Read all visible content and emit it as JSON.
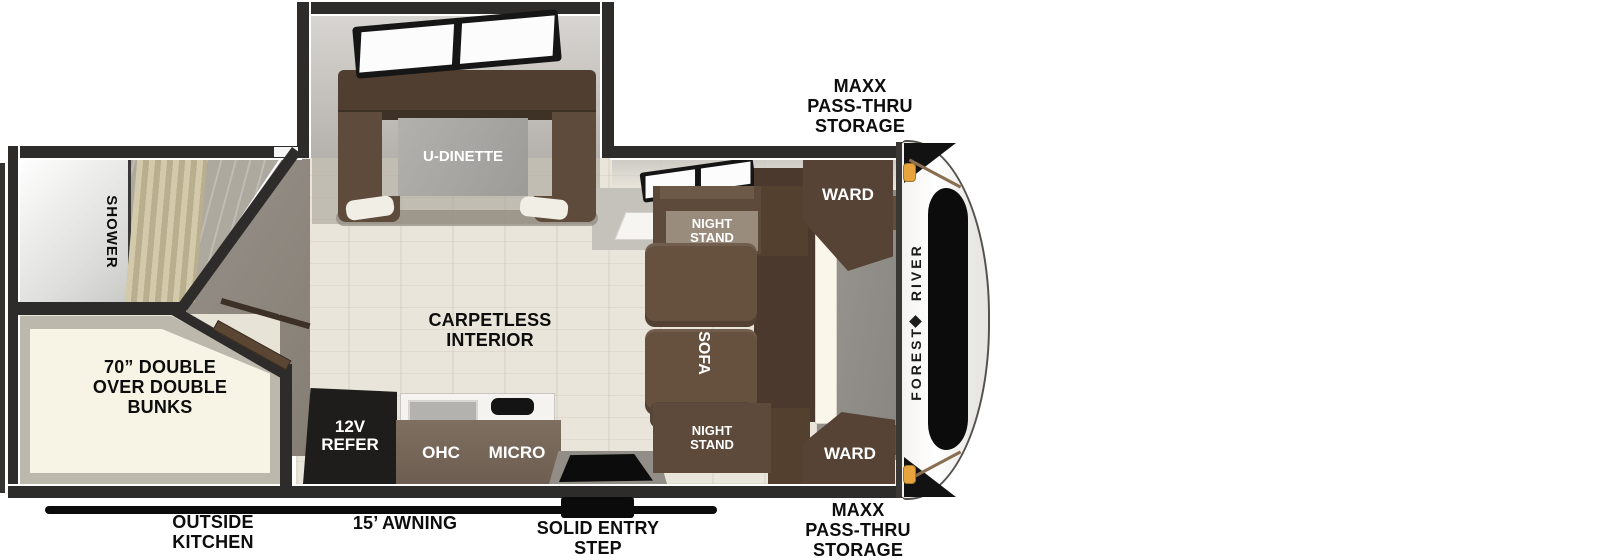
{
  "exterior": {
    "storage_top": "MAXX\nPASS-THRU\nSTORAGE",
    "storage_bottom": "MAXX\nPASS-THRU\nSTORAGE",
    "outside_kitchen": "OUTSIDE\nKITCHEN",
    "awning": "15’ AWNING",
    "entry_step": "SOLID ENTRY\nSTEP",
    "brand": "FOREST RIVER"
  },
  "interior": {
    "dinette": "U-DINETTE",
    "carpetless": "CARPETLESS\nINTERIOR",
    "shower": "SHOWER",
    "bunks": "70” DOUBLE\nOVER DOUBLE\nBUNKS",
    "sofa": "SOFA",
    "night_stand_top": "NIGHT\nSTAND",
    "night_stand_bottom": "NIGHT\nSTAND",
    "ward_top": "WARD",
    "ward_bottom": "WARD",
    "refrigerator": "12V\nREFER",
    "overhead_cabinet": "OHC",
    "microwave": "MICRO"
  },
  "colors": {
    "wall": "#2e2c2a",
    "cabinet_brown": "#5e4b3c",
    "floor_beige": "#e9e5da",
    "marker_light_orange": "#e8a33d"
  }
}
